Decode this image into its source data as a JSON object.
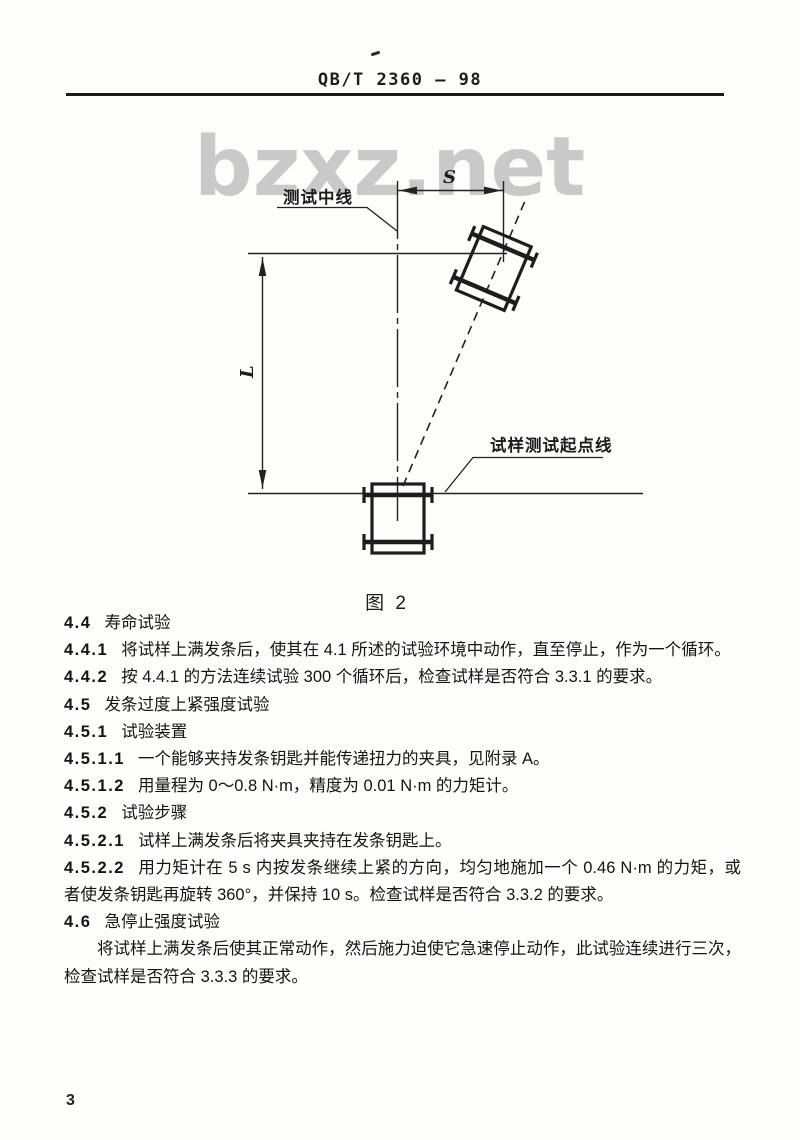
{
  "page": {
    "watermark": "bzxz.net",
    "page_number": "3"
  },
  "header": {
    "standard_code": "QB/T 2360 — 98"
  },
  "figure": {
    "caption": "图 2",
    "label_center_line": "测试中线",
    "label_start_line": "试样测试起点线",
    "dim_horizontal": "S",
    "dim_vertical": "L"
  },
  "body": {
    "clauses": [
      {
        "num": "4.4",
        "text": "寿命试验"
      },
      {
        "num": "4.4.1",
        "text": "将试样上满发条后，使其在 4.1 所述的试验环境中动作，直至停止，作为一个循环。"
      },
      {
        "num": "4.4.2",
        "text": "按 4.4.1 的方法连续试验 300 个循环后，检查试样是否符合 3.3.1 的要求。"
      },
      {
        "num": "4.5",
        "text": "发条过度上紧强度试验"
      },
      {
        "num": "4.5.1",
        "text": "试验装置"
      },
      {
        "num": "4.5.1.1",
        "text": "一个能够夹持发条钥匙并能传递扭力的夹具，见附录 A。"
      },
      {
        "num": "4.5.1.2",
        "text": "用量程为 0～0.8 N·m，精度为 0.01 N·m 的力矩计。"
      },
      {
        "num": "4.5.2",
        "text": "试验步骤"
      },
      {
        "num": "4.5.2.1",
        "text": "试样上满发条后将夹具夹持在发条钥匙上。"
      },
      {
        "num": "4.5.2.2",
        "text": "用力矩计在 5 s 内按发条继续上紧的方向，均匀地施加一个 0.46 N·m 的力矩，或者使发条钥匙再旋转 360°，并保持 10 s。检查试样是否符合 3.3.2 的要求。"
      },
      {
        "num": "4.6",
        "text": "急停止强度试验"
      },
      {
        "num": "",
        "text": "将试样上满发条后使其正常动作，然后施力迫使它急速停止动作，此试验连续进行三次，检查试样是否符合 3.3.3 的要求。"
      }
    ]
  }
}
